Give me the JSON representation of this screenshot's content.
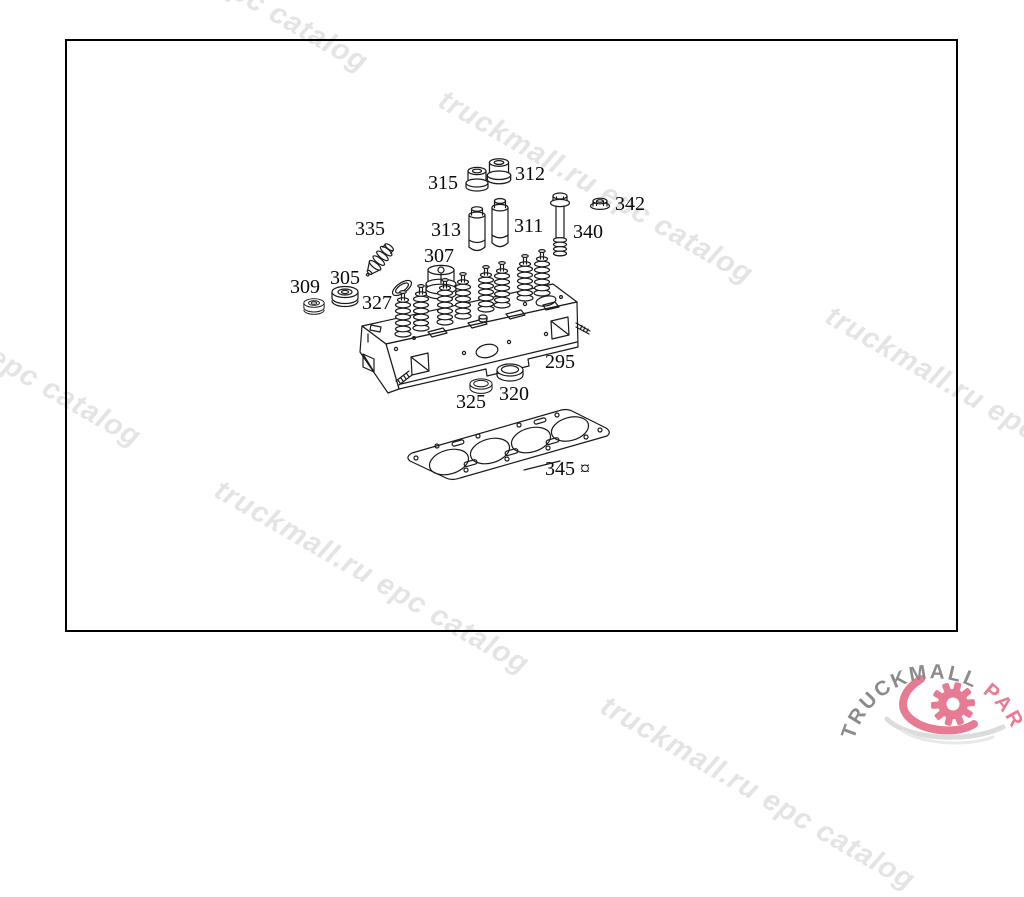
{
  "watermark": {
    "text": "truckmall.ru epc catalog",
    "color": "#e4e4e4"
  },
  "diagram": {
    "title": "cylinder-head-exploded-view",
    "parts": [
      {
        "id": "315",
        "label": "315",
        "x": 428,
        "y": 173
      },
      {
        "id": "312",
        "label": "312",
        "x": 515,
        "y": 164
      },
      {
        "id": "313",
        "label": "313",
        "x": 431,
        "y": 220
      },
      {
        "id": "311",
        "label": "311",
        "x": 514,
        "y": 216
      },
      {
        "id": "340",
        "label": "340",
        "x": 573,
        "y": 222
      },
      {
        "id": "342",
        "label": "342",
        "x": 615,
        "y": 194
      },
      {
        "id": "307",
        "label": "307",
        "x": 424,
        "y": 246
      },
      {
        "id": "335",
        "label": "335",
        "x": 355,
        "y": 219
      },
      {
        "id": "305",
        "label": "305",
        "x": 330,
        "y": 268
      },
      {
        "id": "309",
        "label": "309",
        "x": 290,
        "y": 277
      },
      {
        "id": "327",
        "label": "327",
        "x": 362,
        "y": 293
      },
      {
        "id": "295",
        "label": "295",
        "x": 545,
        "y": 352
      },
      {
        "id": "325",
        "label": "325",
        "x": 456,
        "y": 392
      },
      {
        "id": "320",
        "label": "320",
        "x": 499,
        "y": 384
      },
      {
        "id": "345",
        "label": "345 ¤",
        "x": 545,
        "y": 459
      }
    ]
  },
  "logo": {
    "part1": "TRUCKMALL",
    "part2": "PARTS",
    "color_primary": "#8b8b8b",
    "color_accent": "#e87b94"
  }
}
